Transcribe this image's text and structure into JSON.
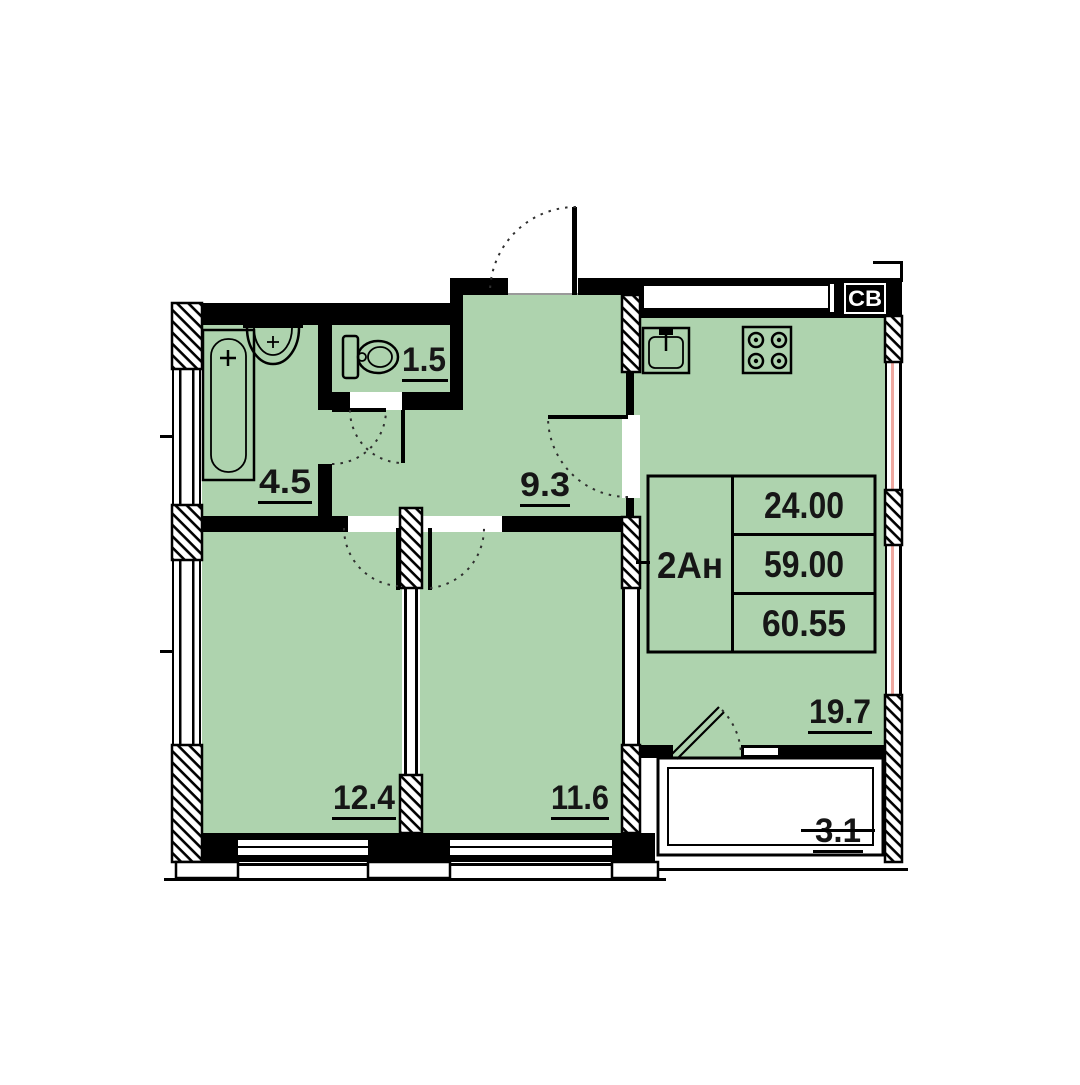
{
  "plan": {
    "vent_label": "СВ",
    "info_table": {
      "unit_type": "2Ан",
      "values": [
        "24.00",
        "59.00",
        "60.55"
      ]
    },
    "room_areas": {
      "wc": "1.5",
      "bathroom": "4.5",
      "hallway": "9.3",
      "bedroom_1": "12.4",
      "bedroom_2": "11.6",
      "kitchen_living": "19.7",
      "balcony": "3.1"
    },
    "colors": {
      "room_fill": "#aed3ae",
      "wall": "#000000",
      "window_accent": "#efa8a0"
    }
  }
}
